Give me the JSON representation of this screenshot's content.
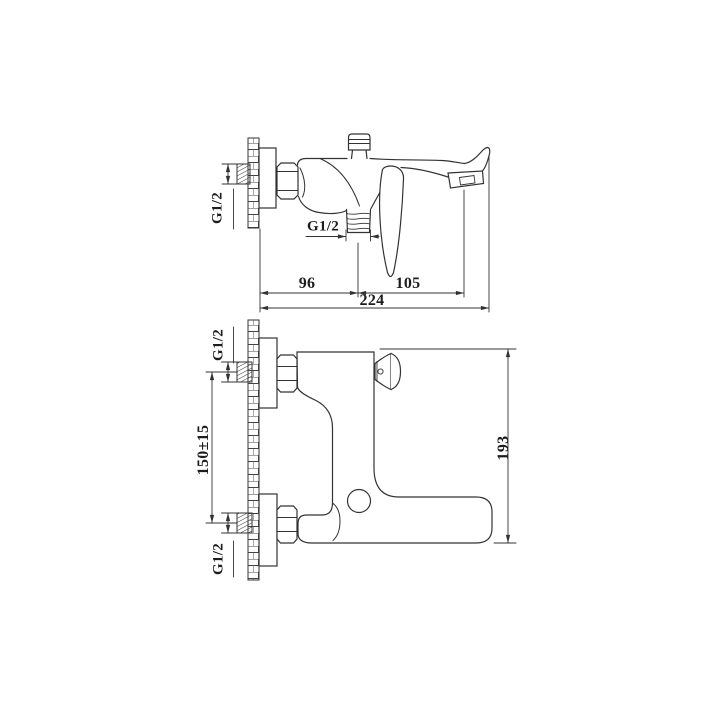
{
  "page": {
    "background": "#ffffff",
    "ink": "#333333",
    "description": "Technical dimension drawing of a wall-mounted bath mixer faucet, side view (top) and rotated front view (bottom)"
  },
  "drawing": {
    "side_view": {
      "wall_inlet_thread_label": "G1/2",
      "shower_outlet_thread_label": "G1/2",
      "dim_wall_to_outlet_mm": "96",
      "dim_outlet_to_spout_mm": "105",
      "dim_total_depth_mm": "224"
    },
    "front_view": {
      "inlet_thread_label_top": "G1/2",
      "inlet_thread_label_bottom": "G1/2",
      "dim_inlet_spacing_mm": "150±15",
      "dim_body_height_mm": "193"
    }
  }
}
